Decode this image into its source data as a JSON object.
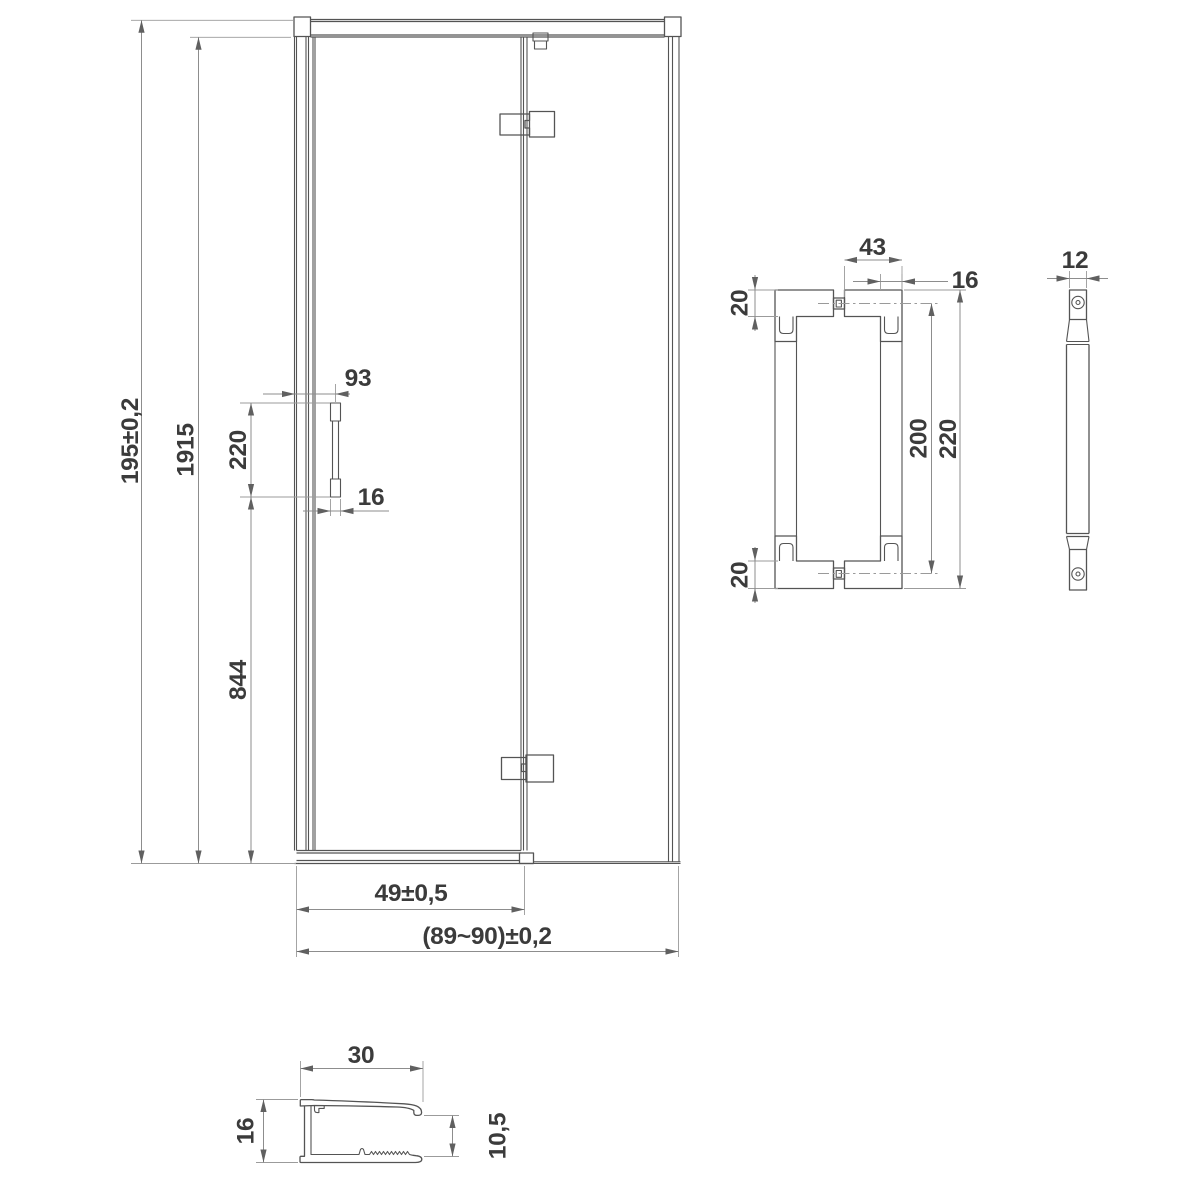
{
  "drawing_type": "shower door technical dimension drawing",
  "door_view": {
    "overall_height": "195±0,2",
    "glass_height": "1915",
    "handle_offset": "93",
    "handle_length": "220",
    "handle_width": "16",
    "handle_bottom_distance": "844",
    "door_width": "49±0,5",
    "total_width": "(89~90)±0,2"
  },
  "handle_front": {
    "block_width": "43",
    "bar_width": "16",
    "block_height_top": "20",
    "holes_distance": "200",
    "total_length": "220",
    "block_height_bottom": "20"
  },
  "handle_side": {
    "depth": "12"
  },
  "profile": {
    "width": "30",
    "height": "16",
    "channel_height": "10,5"
  },
  "colors": {
    "object_line": "#545454",
    "dimension_line": "#8d8d8d",
    "arrow": "#606060",
    "text": "#3b3b3b",
    "background": "#ffffff"
  }
}
